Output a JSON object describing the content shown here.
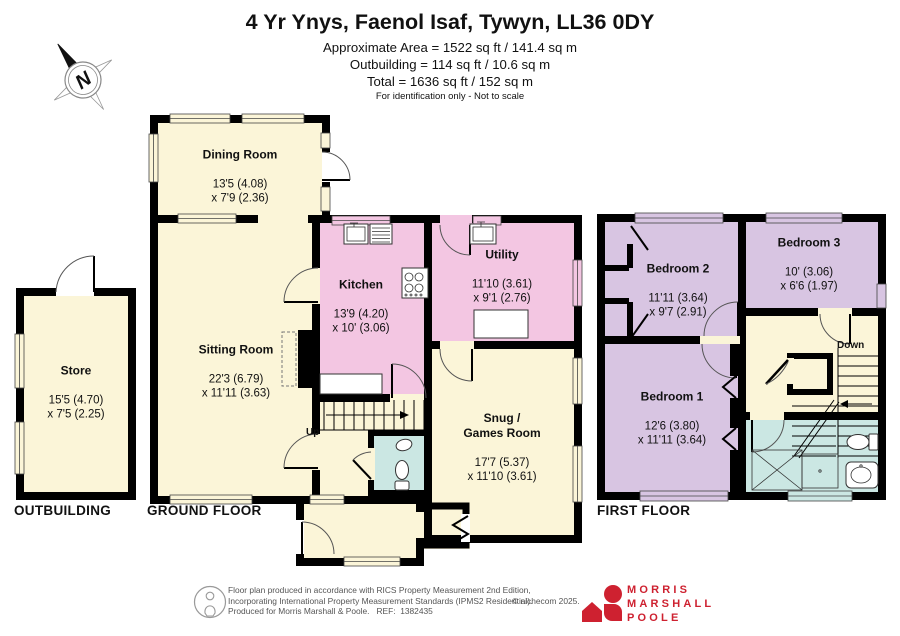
{
  "header": {
    "title": "4 Yr Ynys, Faenol Isaf, Tywyn, LL36 0DY",
    "line1": "Approximate Area = 1522 sq ft / 141.4 sq m",
    "line2": "Outbuilding = 114 sq ft / 10.6 sq m",
    "line3": "Total = 1636 sq ft / 152 sq m",
    "disclaimer": "For identification only - Not to scale"
  },
  "compass": {
    "north": "N"
  },
  "rooms": {
    "store": {
      "name": "Store",
      "dims": "15'5 (4.70)\nx 7'5 (2.25)"
    },
    "dining": {
      "name": "Dining Room",
      "dims": "13'5 (4.08)\nx 7'9 (2.36)"
    },
    "sitting": {
      "name": "Sitting Room",
      "dims": "22'3 (6.79)\nx 11'11 (3.63)"
    },
    "kitchen": {
      "name": "Kitchen",
      "dims": "13'9 (4.20)\nx 10' (3.06)"
    },
    "utility": {
      "name": "Utility",
      "dims": "11'10 (3.61)\nx 9'1 (2.76)"
    },
    "snug": {
      "name": "Snug /\nGames Room",
      "dims": "17'7 (5.37)\nx 11'10 (3.61)"
    },
    "bedroom1": {
      "name": "Bedroom 1",
      "dims": "12'6 (3.80)\nx 11'11 (3.64)"
    },
    "bedroom2": {
      "name": "Bedroom 2",
      "dims": "11'11 (3.64)\nx 9'7 (2.91)"
    },
    "bedroom3": {
      "name": "Bedroom 3",
      "dims": "10' (3.06)\nx 6'6 (1.97)"
    }
  },
  "labels": {
    "outbuilding": "OUTBUILDING",
    "ground": "GROUND FLOOR",
    "first": "FIRST FLOOR",
    "up": "Up",
    "down": "Down"
  },
  "footer": {
    "line1": "Floor plan produced in accordance with RICS Property Measurement 2nd Edition,",
    "line2": "Incorporating International Property Measurement Standards (IPMS2 Residential).",
    "line3": "Produced for Morris Marshall & Poole.   REF:  1382435",
    "copyright": "© nichecom 2025.",
    "logo": {
      "l1": "MORRIS",
      "l2": "MARSHALL",
      "l3": "POOLE"
    }
  },
  "colors": {
    "cream": "#FBF5D8",
    "pink": "#F3C6E2",
    "lavender": "#D8C5E2",
    "cyan": "#CBE7E3",
    "wall": "#000000",
    "logo_red": "#CE2130"
  }
}
